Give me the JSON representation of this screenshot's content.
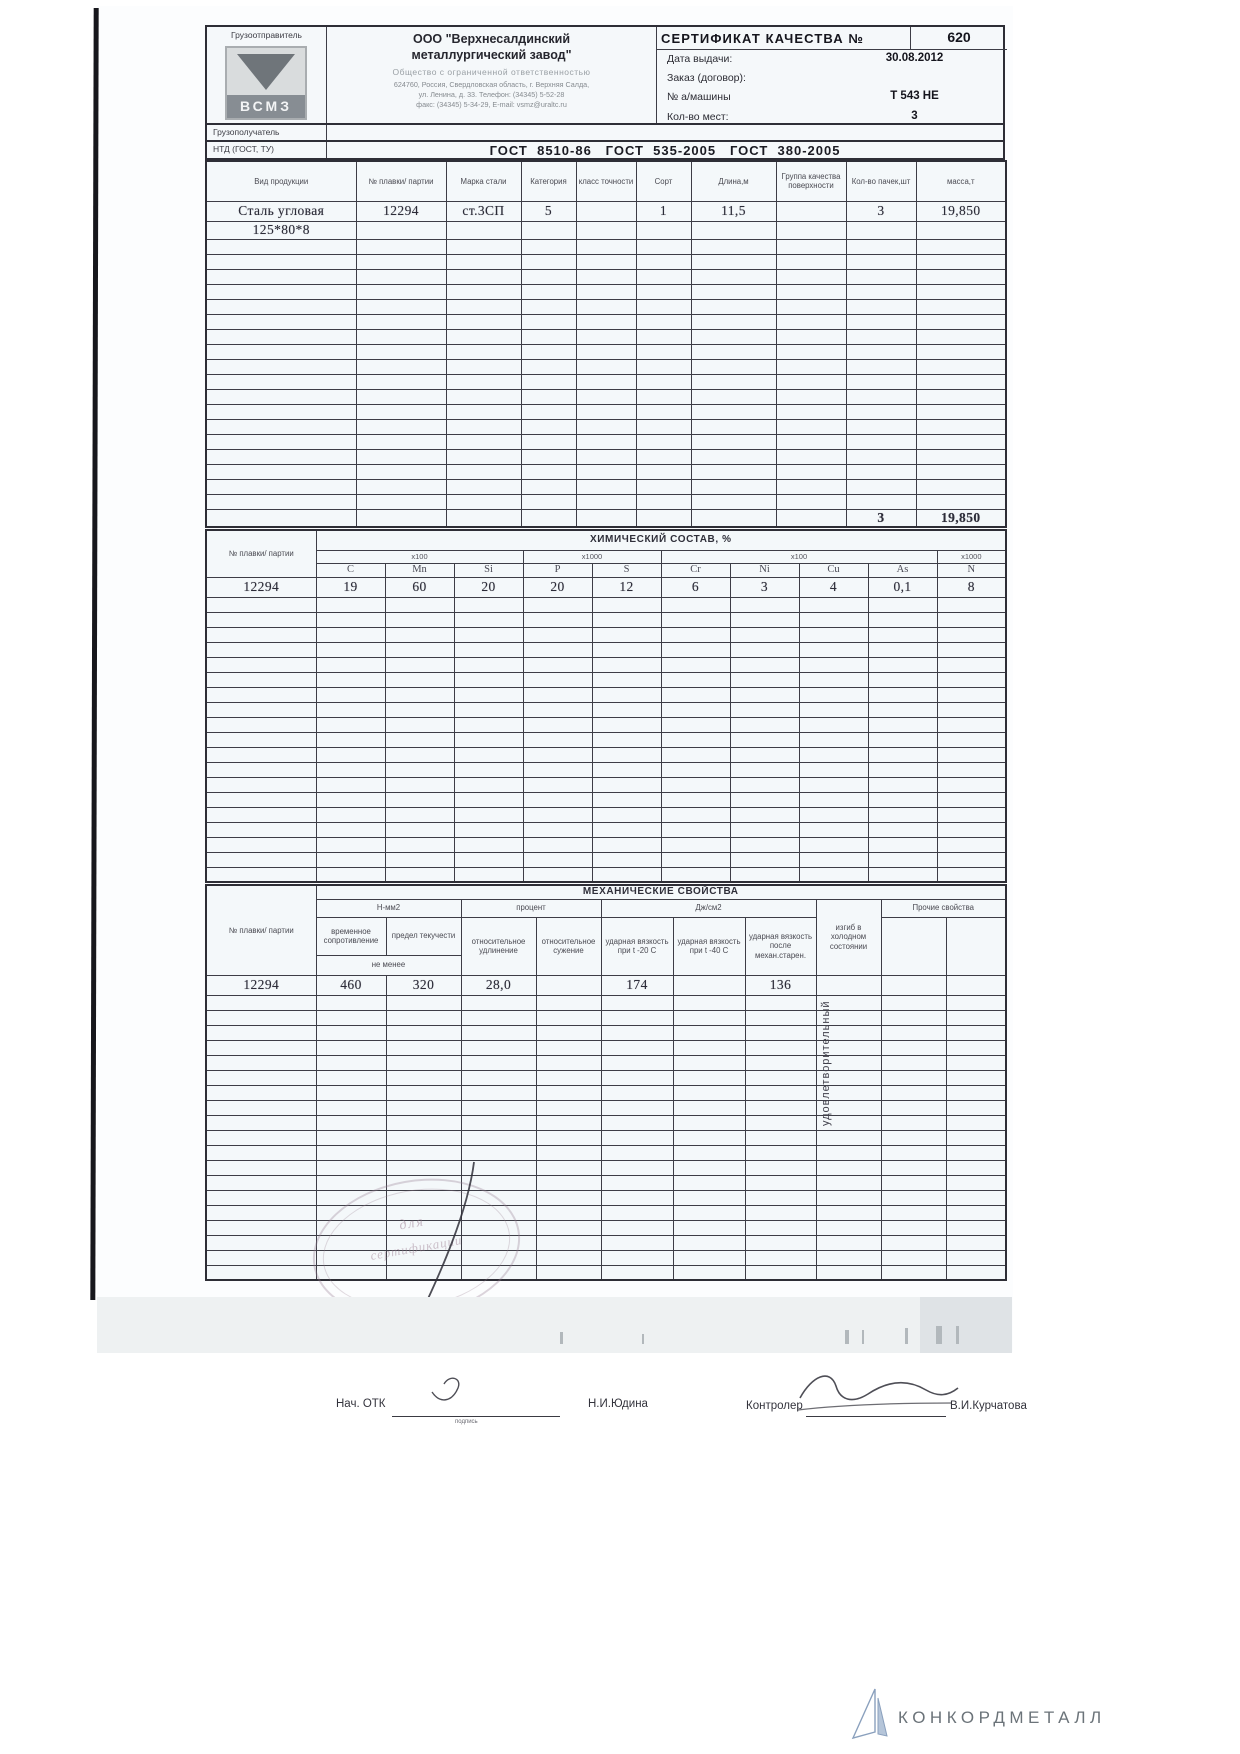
{
  "header": {
    "shipper_label": "Грузоотправитель",
    "logo_text": "ВСМЗ",
    "company": {
      "name_line1": "ООО \"Верхнесалдинский",
      "name_line2": "металлургический завод\"",
      "type_line": "Общество с ограниченной ответственностью",
      "address_line1": "624760, Россия, Свердловская область, г. Верхняя Салда,",
      "address_line2": "ул. Ленина, д. 33. Телефон: (34345) 5-52-28",
      "address_line3": "факс: (34345) 5-34-29, E-mail: vsmz@uraltc.ru"
    },
    "certificate": {
      "title": "СЕРТИФИКАТ КАЧЕСТВА №",
      "number": "620",
      "fields": [
        {
          "label": "Дата выдачи:",
          "value": "30.08.2012"
        },
        {
          "label": "Заказ (договор):",
          "value": ""
        },
        {
          "label": "№ а/машины",
          "value": "Т 543 НЕ"
        },
        {
          "label": "Кол-во мест:",
          "value": "3"
        }
      ]
    }
  },
  "consignee": {
    "label": "Грузополучатель",
    "value": ""
  },
  "ntd": {
    "label": "НТД (ГОСТ, ТУ)",
    "value": "ГОСТ  8510-86   ГОСТ  535-2005   ГОСТ  380-2005"
  },
  "product_table": {
    "columns": [
      "Вид продукции",
      "№ плавки/ партии",
      "Марка стали",
      "Категория",
      "класс точности",
      "Сорт",
      "Длина,м",
      "Группа качества поверхности",
      "Кол-во пачек,шт",
      "масса,т"
    ],
    "rows": [
      [
        "Сталь угловая",
        "12294",
        "ст.3СП",
        "5",
        "",
        "1",
        "11,5",
        "",
        "3",
        "19,850"
      ],
      [
        "125*80*8",
        "",
        "",
        "",
        "",
        "",
        "",
        "",
        "",
        ""
      ]
    ],
    "totals_row": [
      "",
      "",
      "",
      "",
      "",
      "",
      "",
      "",
      "3",
      "19,850"
    ],
    "empty_row_count": 18
  },
  "chem_table": {
    "title": "ХИМИЧЕСКИЙ СОСТАВ, %",
    "col0_label": "№ плавки/ партии",
    "scale_groups": [
      {
        "label": "х100",
        "span": 3
      },
      {
        "label": "х1000",
        "span": 2
      },
      {
        "label": "х100",
        "span": 4
      },
      {
        "label": "х1000",
        "span": 1
      }
    ],
    "elements": [
      "C",
      "Mn",
      "Si",
      "P",
      "S",
      "Cr",
      "Ni",
      "Cu",
      "As",
      "N"
    ],
    "data_row": {
      "heat": "12294",
      "values": [
        "19",
        "60",
        "20",
        "20",
        "12",
        "6",
        "3",
        "4",
        "0,1",
        "8"
      ]
    },
    "empty_row_count": 19
  },
  "mech_table": {
    "title": "МЕХАНИЧЕСКИЕ СВОЙСТВА",
    "col0_label": "№ плавки/ партии",
    "group_nmm2": "Н-мм2",
    "group_percent": "процент",
    "group_j": "Дж/см2",
    "group_other": "Прочие свойства",
    "sub_headers": [
      "временное сопротивление",
      "предел текучести",
      "относительное удлинение",
      "относительное сужение",
      "ударная вязкость при t -20 С",
      "ударная вязкость при t -40 С",
      "ударная вязкость после механ.старен."
    ],
    "bend_label": "изгиб в холодном состоянии",
    "ne_menee": "не менее",
    "data_row": {
      "heat": "12294",
      "values": [
        "460",
        "320",
        "28,0",
        "",
        "174",
        "",
        "136",
        "",
        "",
        ""
      ]
    },
    "bend_result": "удовлетворительный",
    "empty_row_count": 19
  },
  "notes": {
    "line1": "Примечание:  Указанная в сертификате продукция соответствует действующим в России стандартам и техническим условиям",
    "line2": "При переписке по вопросам качества ссылайтесь на номер сертификата"
  },
  "signatures": {
    "otk_label": "Нач. ОТК",
    "otk_caption": "подпись",
    "otk_name": "Н.И.Юдина",
    "controller_label": "Контролер",
    "controller_name": "В.И.Курчатова"
  },
  "stamp": {
    "line1": "для",
    "line2": "сертификации"
  },
  "footer": {
    "brand": "КОНКОРДМЕТАЛЛ"
  }
}
